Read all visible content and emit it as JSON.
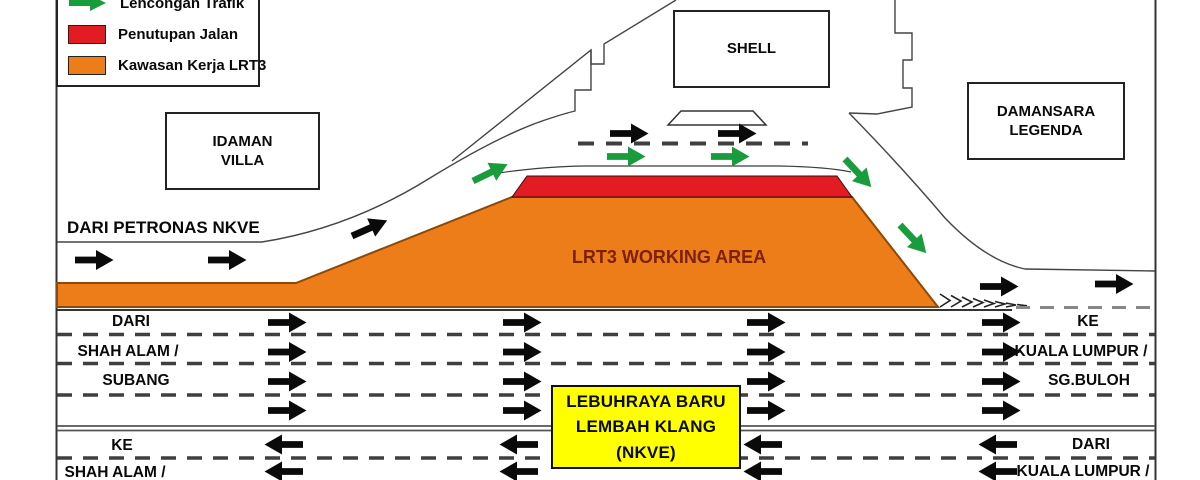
{
  "legend": {
    "items": [
      {
        "label": "Lencongan Trafik",
        "swatch": "green-arrow"
      },
      {
        "label": "Penutupan Jalan",
        "swatch": "red-rect"
      },
      {
        "label": "Kawasan Kerja LRT3",
        "swatch": "orange-rect"
      }
    ]
  },
  "landmarks": {
    "idaman": {
      "line1": "IDAMAN",
      "line2": "VILLA"
    },
    "shell": {
      "line1": "SHELL"
    },
    "damansara": {
      "line1": "DAMANSARA",
      "line2": "LEGENDA"
    }
  },
  "labels": {
    "dari_petronas": "DARI PETRONAS NKVE",
    "working_area": "LRT3 WORKING AREA"
  },
  "nkve_box": {
    "line1": "LEBUHRAYA BARU",
    "line2": "LEMBAH KLANG",
    "line3": "(NKVE)"
  },
  "lanes": {
    "upper_left": [
      "DARI",
      "SHAH ALAM /",
      "SUBANG"
    ],
    "upper_right": [
      "KE",
      "KUALA LUMPUR /",
      "SG.BULOH"
    ],
    "lower_left": [
      "KE",
      "SHAH ALAM /"
    ],
    "lower_right": [
      "DARI",
      "KUALA LUMPUR /"
    ]
  },
  "traffic_flow": {
    "upper_carriageway_direction": "right",
    "lower_carriageway_direction": "left",
    "upper_lanes": 4,
    "lower_lanes": 2
  },
  "colors": {
    "working_area": "#ED7D18",
    "road_closure": "#E31B23",
    "diversion_arrow": "#189C3C",
    "nkve_box_bg": "#FFFF00",
    "working_area_text": "#7B2100"
  }
}
